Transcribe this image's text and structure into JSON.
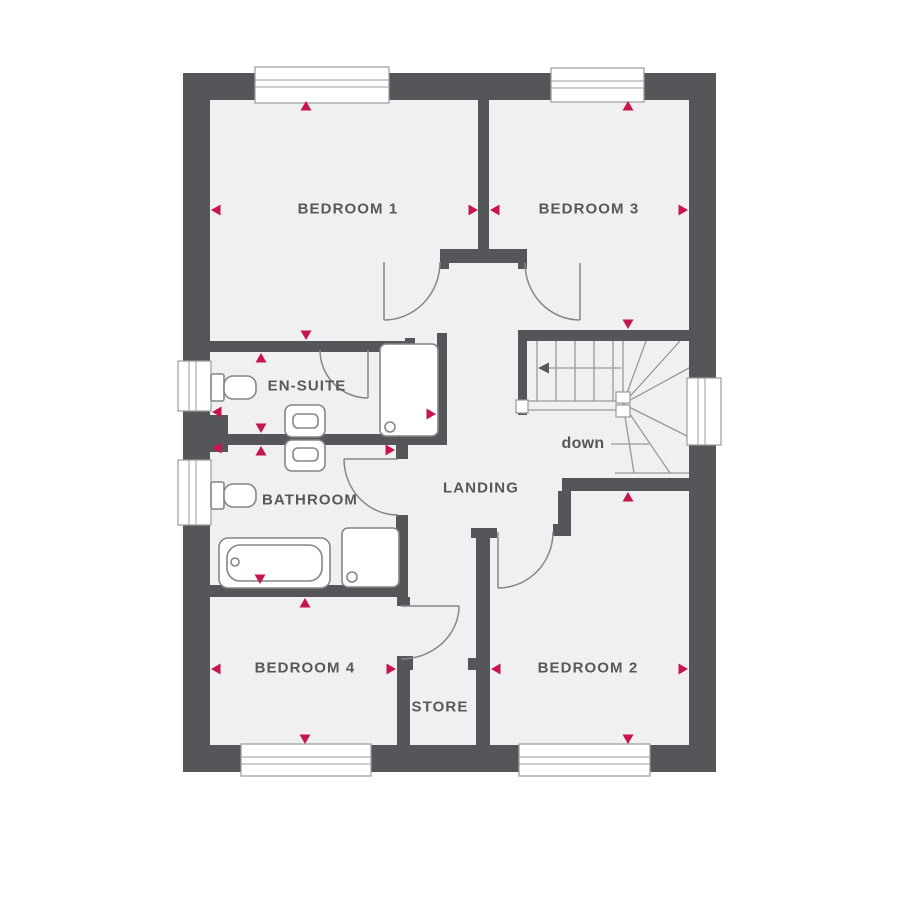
{
  "plan": {
    "rooms": {
      "bedroom1": {
        "label": "BEDROOM 1"
      },
      "bedroom2": {
        "label": "BEDROOM 2"
      },
      "bedroom3": {
        "label": "BEDROOM 3"
      },
      "bedroom4": {
        "label": "BEDROOM 4"
      },
      "ensuite": {
        "label": "EN-SUITE"
      },
      "bathroom": {
        "label": "BATHROOM"
      },
      "landing": {
        "label": "LANDING"
      },
      "store": {
        "label": "STORE"
      }
    },
    "stairs": {
      "direction_label": "down"
    },
    "fixtures": [
      {
        "name": "toilet",
        "room": "en-suite"
      },
      {
        "name": "washbasin",
        "room": "en-suite"
      },
      {
        "name": "shower",
        "room": "en-suite"
      },
      {
        "name": "toilet",
        "room": "bathroom"
      },
      {
        "name": "washbasin",
        "room": "bathroom"
      },
      {
        "name": "bathtub",
        "room": "bathroom"
      },
      {
        "name": "shower",
        "room": "bathroom"
      }
    ],
    "colors": {
      "wall": "#555659",
      "floor": "#f0f0f2",
      "dimension_marker": "#c8154c",
      "label_text": "#58585a",
      "fixture_line": "#85868a"
    }
  }
}
